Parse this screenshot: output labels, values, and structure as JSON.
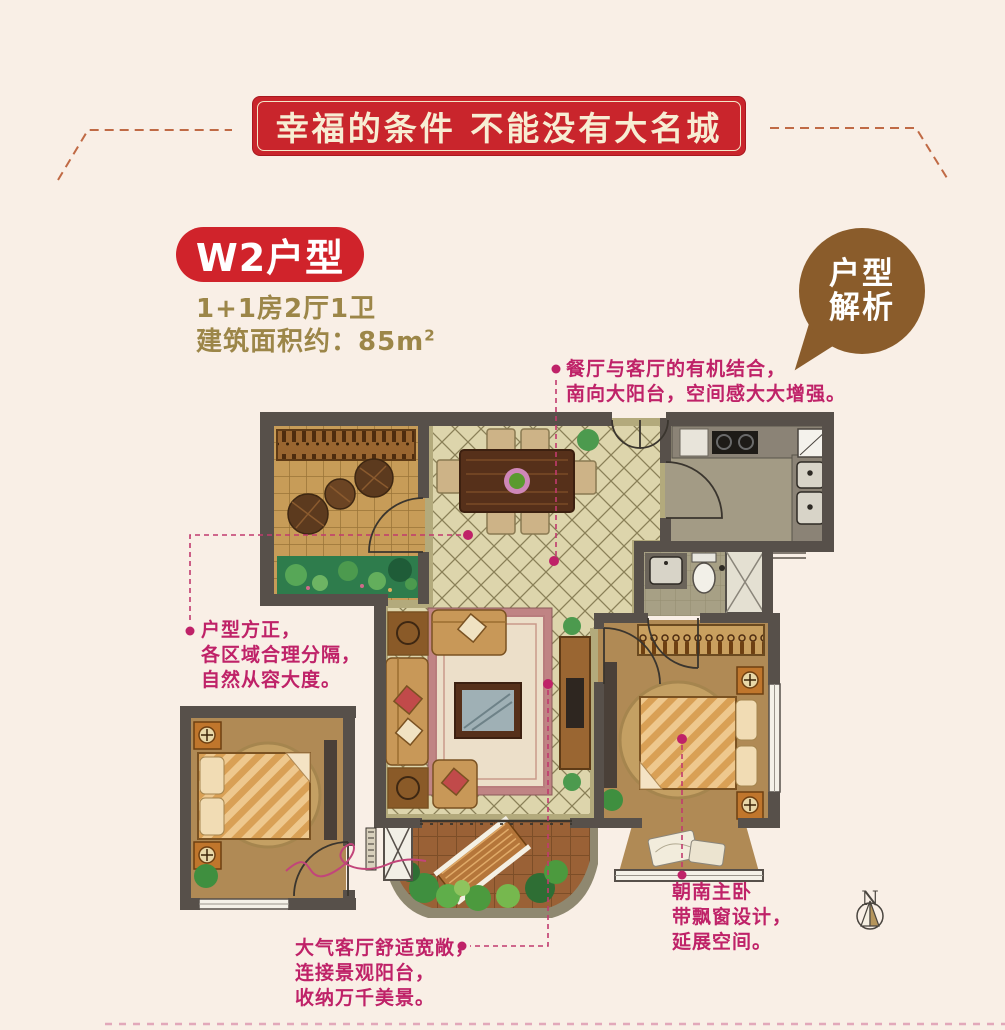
{
  "banner": {
    "text": "幸福的条件 不能没有大名城"
  },
  "unit": {
    "title": "W2户型",
    "layout": "1+1房2厅1卫",
    "area_label": "建筑面积约：85m",
    "area_sup": "2"
  },
  "bubble": {
    "lines": [
      "户型",
      "解析"
    ]
  },
  "annotations": [
    {
      "id": "dining",
      "lines": [
        "餐厅与客厅的有机结合，",
        "南向大阳台，空间感大大增强。"
      ]
    },
    {
      "id": "layout",
      "lines": [
        "户型方正，",
        "各区域合理分隔，",
        "自然从容大度。"
      ]
    },
    {
      "id": "master",
      "lines": [
        "朝南主卧",
        "带飘窗设计，",
        "延展空间。"
      ]
    },
    {
      "id": "living",
      "lines": [
        "大气客厅舒适宽敞，",
        "连接景观阳台，",
        "收纳万千美景。"
      ]
    }
  ],
  "compass": {
    "label": "N"
  },
  "colors": {
    "background": "#f9efe6",
    "banner_bg": "#c9252c",
    "banner_text": "#f7edd3",
    "title_bg": "#d0232b",
    "subtitle_text": "#9c8648",
    "bubble_bg": "#8a5c2b",
    "annotation": "#bf2268",
    "wall": "#57504a",
    "diamond_floor": "#ddd5ac",
    "wood_floor": "#b08a55",
    "garden_green": "#2e7c4c"
  }
}
